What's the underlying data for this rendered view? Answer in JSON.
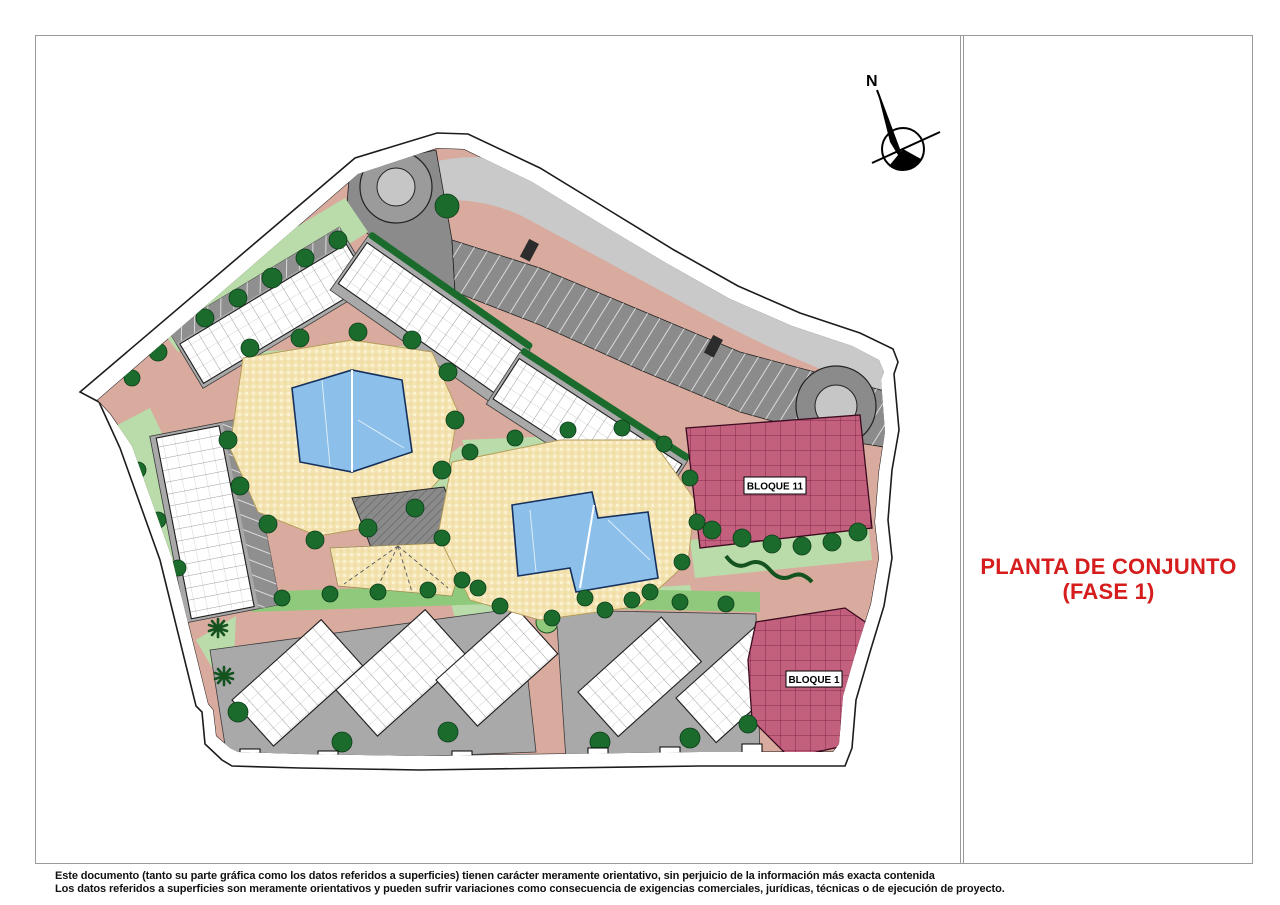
{
  "title_block": {
    "line1": "PLANTA DE CONJUNTO",
    "line2": "(FASE 1)"
  },
  "compass": {
    "north_label": "N"
  },
  "plan": {
    "blocks": [
      {
        "id": "bloque-11",
        "label": "BLOQUE 11"
      },
      {
        "id": "bloque-1",
        "label": "BLOQUE 1"
      }
    ]
  },
  "disclaimer": {
    "line1": "Este documento (tanto su parte gráfica como los datos referidos a superficies) tienen carácter meramente orientativo, sin perjuicio de la información más exacta contenida",
    "line2": "Los datos referidos a superficies son meramente orientativos y pueden sufrir variaciones como consecuencia de exigencias comerciales, jurídicas, técnicas o de ejecución de proyecto."
  },
  "colors": {
    "sheet_bg": "#ffffff",
    "frame_line": "#9a9a9a",
    "title_red": "#d61d1d",
    "text_black": "#111111",
    "path_pink": "#d9ab9e",
    "road_light": "#c9c9c9",
    "parking_dark": "#8b8b8b",
    "roundabout_inner": "#c6c6c6",
    "garden_light": "#b9dcaa",
    "garden_mid": "#8fca7c",
    "tree_green": "#1b6b2d",
    "tree_edge": "#0d3d1a",
    "building_gray": "#a9a9a9",
    "building_white": "#ffffff",
    "outline": "#1c1c1c",
    "deck_cream": "#f4e4b4",
    "pool_blue": "#8cc0ea",
    "pool_outline": "#16305e",
    "bloque_maroon": "#c2607e",
    "maroon_line": "#6b1836"
  }
}
